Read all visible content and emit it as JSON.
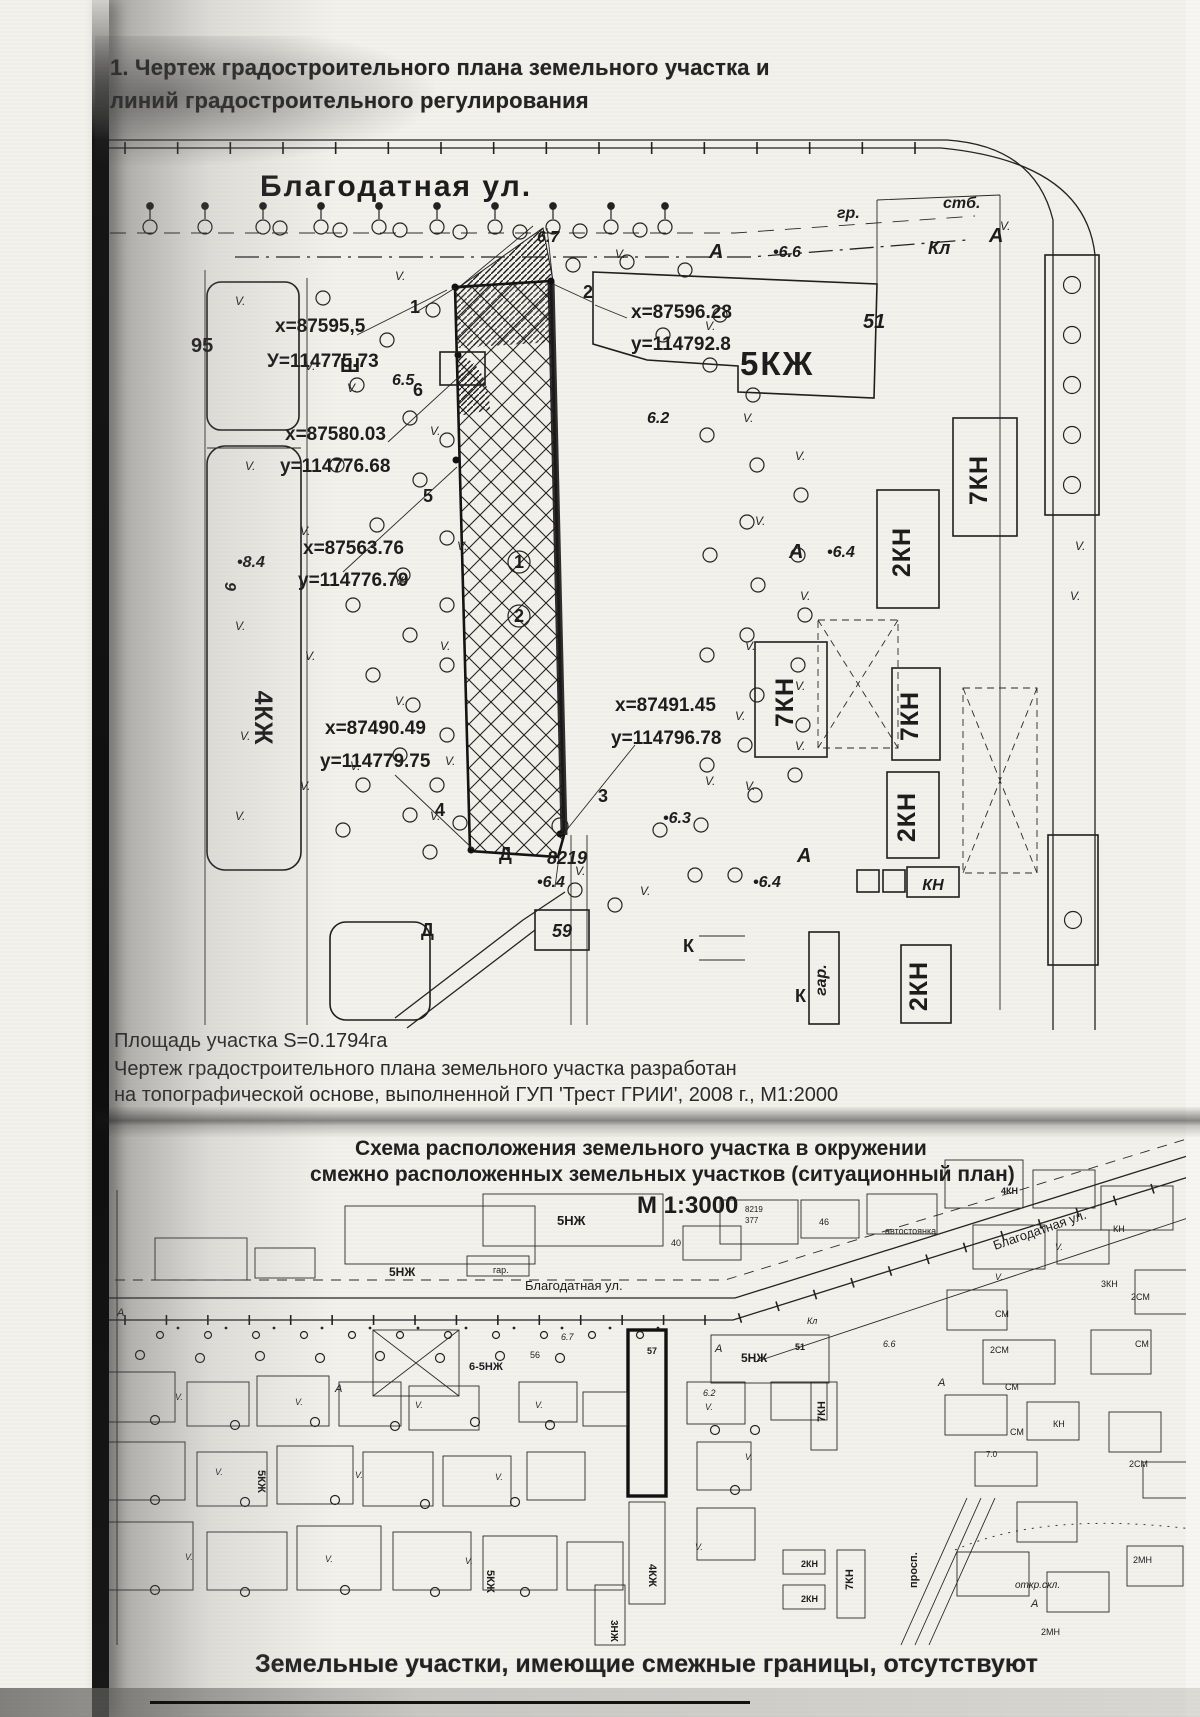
{
  "title": {
    "line1": "1. Чертеж градостроительного плана земельного участка и",
    "line2": "линий градостроительного регулирования"
  },
  "map1": {
    "street": "Благодатная ул.",
    "veg": "V.",
    "coords": [
      {
        "x": "х=87595,5",
        "y": "У=114775.73"
      },
      {
        "x": "x=87596.28",
        "y": "y=114792.8"
      },
      {
        "x": "x=87580.03",
        "y": "у=114776.68"
      },
      {
        "x": "x=87563.76",
        "y": "у=114776.79"
      },
      {
        "x": "x=87490.49",
        "y": "у=114779.75"
      },
      {
        "x": "x=87491.45",
        "y": "у=114796.78"
      }
    ],
    "points": [
      "1",
      "2",
      "3",
      "4",
      "5",
      "6"
    ],
    "circled": [
      "1",
      "2"
    ],
    "buildings": [
      "5КЖ",
      "7КН",
      "2КН",
      "7КН",
      "7КН",
      "2КН",
      "КН",
      "2КН",
      "4КЖ"
    ],
    "elevations": [
      "6.7",
      "6.5",
      "6.2",
      "•6.6",
      "•6.4",
      "•6.3",
      "•6.4",
      "•6.4",
      "•8.4"
    ],
    "misc": {
      "gr": "гр.",
      "stb": "стб.",
      "kl": "Кл",
      "a": "А",
      "num51": "51",
      "n9": "9",
      "d": "Д",
      "n59": "59",
      "k": "К",
      "gar": "гар.",
      "sh": "Ш",
      "n95": "95",
      "n8219": "8219"
    },
    "captions": {
      "area": "Площадь участка S=0.1794га",
      "l2": "Чертеж градостроительного плана земельного участка разработан",
      "l3": "на топографической основе, выполненной ГУП 'Трест ГРИИ', 2008 г., М1:2000"
    }
  },
  "map2": {
    "header1": "Схема расположения земельного участка  в окружении",
    "header2": "смежно расположенных земельных участков (ситуационный план)",
    "scale": "М 1:3000",
    "street": "Благодатная ул.",
    "parcel": "57",
    "bld": {
      "b5nzh": "5НЖ",
      "b65nzh": "6-5НЖ",
      "b51": "51",
      "b7kn": "7КН",
      "b5kzh": "5КЖ",
      "b4kzh": "4КЖ",
      "b3nzh": "3НЖ",
      "b2kn": "2КН",
      "b4kn": "4КН",
      "bsm": "СМ",
      "b2sm": "2СМ",
      "bkn": "КН",
      "b2mn": "2МН",
      "b3kn": "3КН"
    },
    "misc": {
      "gar": "гар.",
      "n40": "40",
      "n46": "46",
      "n8219": "8219",
      "n377": "377",
      "parking": "автостоянка",
      "prosp": "просп.",
      "okr": "откр.скл.",
      "kl": "Кл",
      "a": "А",
      "n56": "56",
      "n70": "7.0",
      "e67": "6.7",
      "e66": "6.6",
      "e62": "6.2"
    }
  },
  "footer": {
    "caption": "Земельные участки, имеющие смежные границы, отсутствуют"
  }
}
